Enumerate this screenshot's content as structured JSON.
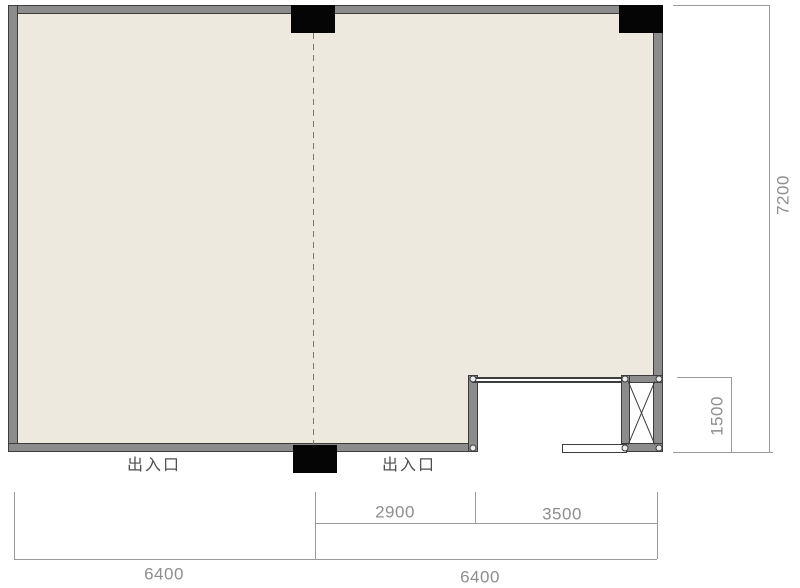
{
  "plan": {
    "type": "floor-plan",
    "entrance_label_left": "出入口",
    "entrance_label_right": "出入口",
    "shaft_symbol": "x-cross"
  },
  "dimensions": {
    "bottom_total_left": "6400",
    "bottom_total_right": "6400",
    "bottom_segment_left": "2900",
    "bottom_segment_right": "3500",
    "right_total": "7200",
    "right_notch": "1500"
  },
  "colors": {
    "floor_fill": "#EDE9DE",
    "wall_fill": "#8C8C8C",
    "wall_border": "#3C3C3C",
    "marker_black": "#050505",
    "dimension_line": "#9A9A9A",
    "dimension_text": "#8E8E8E",
    "entrance_text": "#4F4F4F",
    "background": "#FFFFFF"
  }
}
